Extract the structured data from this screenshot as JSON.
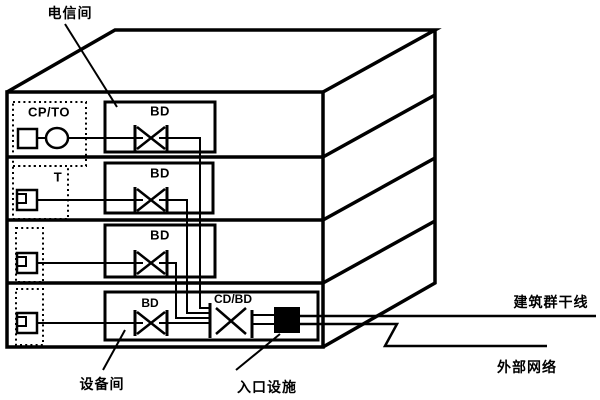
{
  "colors": {
    "line": "#000000",
    "background": "#ffffff",
    "entrance_fill": "#000000"
  },
  "callouts": {
    "telecom_room": "电信间",
    "equipment_room": "设备间",
    "entrance_facility": "入口设施"
  },
  "floors": [
    {
      "room_label": "CP/TO",
      "distributor": "BD"
    },
    {
      "room_label": "T",
      "distributor": "BD"
    },
    {
      "distributor": "BD"
    },
    {
      "distributor": "BD",
      "cross_distributor": "CD/BD"
    }
  ],
  "external": {
    "campus_backbone": "建筑群干线",
    "external_network": "外部网络"
  }
}
